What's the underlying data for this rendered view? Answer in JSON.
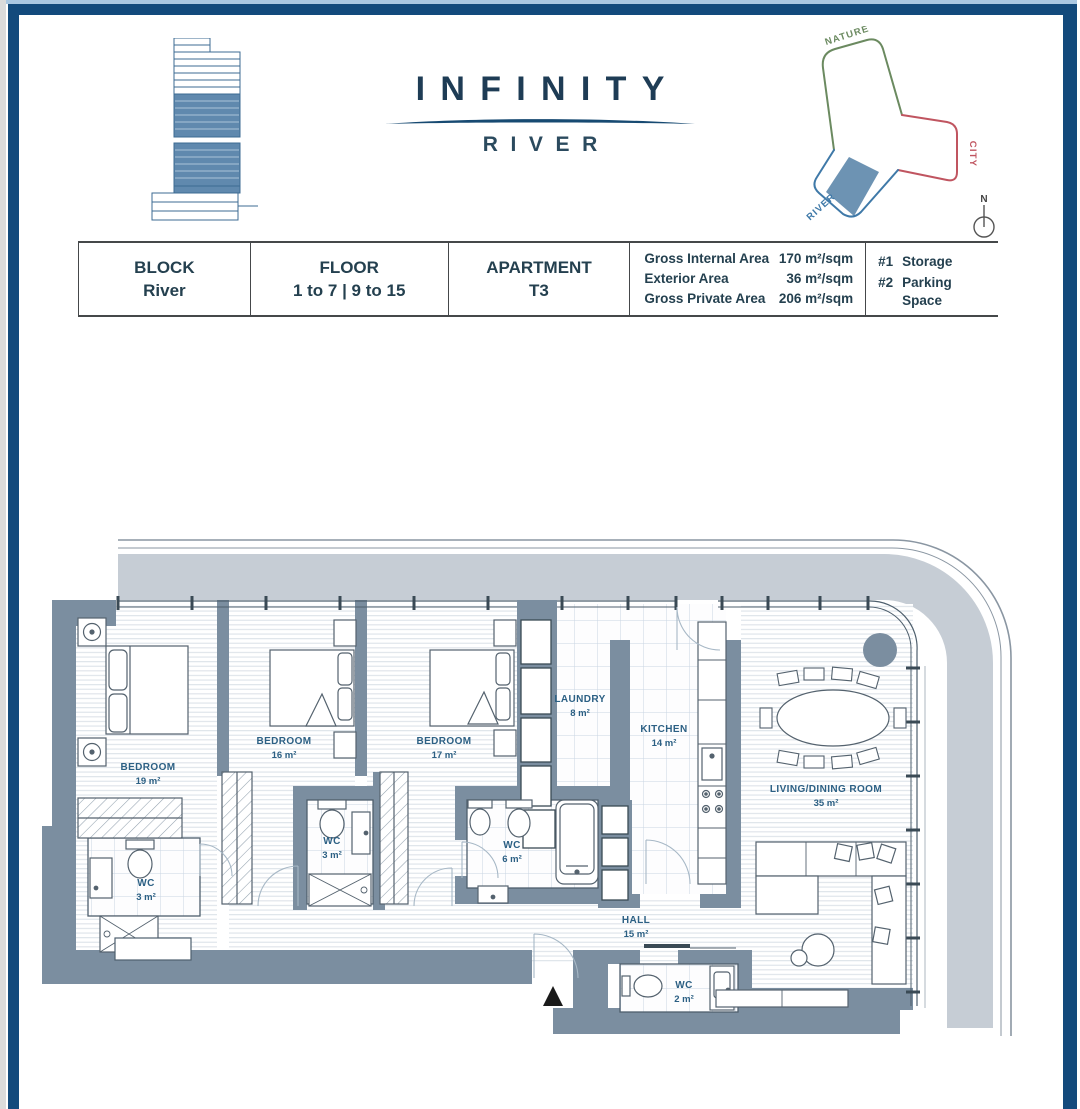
{
  "header": {
    "logo": {
      "title": "INFINITY",
      "subtitle": "RIVER"
    },
    "site_plan": {
      "nature": "NATURE",
      "city": "CITY",
      "river": "RIVER",
      "north": "N",
      "colors": {
        "nature": "#6b8a60",
        "city": "#c05560",
        "river": "#3f79a8",
        "highlight": "#5d87ad"
      }
    }
  },
  "info_table": {
    "block_label": "BLOCK",
    "block_value": "River",
    "floor_label": "FLOOR",
    "floor_value": "1 to 7 | 9 to 15",
    "apartment_label": "APARTMENT",
    "apartment_value": "T3",
    "areas": [
      {
        "label": "Gross Internal Area",
        "value": "170 m²/sqm"
      },
      {
        "label": "Exterior Area",
        "value": "36 m²/sqm"
      },
      {
        "label": "Gross Private Area",
        "value": "206 m²/sqm"
      }
    ],
    "extras": [
      {
        "num": "#1",
        "label": "Storage"
      },
      {
        "num": "#2",
        "label": "Parking Space"
      }
    ]
  },
  "plan": {
    "rooms": [
      {
        "name": "BEDROOM",
        "area": "19 m²"
      },
      {
        "name": "BEDROOM",
        "area": "16 m²"
      },
      {
        "name": "BEDROOM",
        "area": "17 m²"
      },
      {
        "name": "LAUNDRY",
        "area": "8 m²"
      },
      {
        "name": "KITCHEN",
        "area": "14 m²"
      },
      {
        "name": "LIVING/DINING ROOM",
        "area": "35 m²"
      },
      {
        "name": "WC",
        "area": "3 m²"
      },
      {
        "name": "WC",
        "area": "3 m²"
      },
      {
        "name": "WC",
        "area": "6 m²"
      },
      {
        "name": "WC",
        "area": "2 m²"
      },
      {
        "name": "HALL",
        "area": "15 m²"
      }
    ],
    "colors": {
      "wall": "#7b8ea0",
      "terrace": "#c6cdd5",
      "label": "#2c6084",
      "accent_navy": "#134a7c"
    }
  }
}
